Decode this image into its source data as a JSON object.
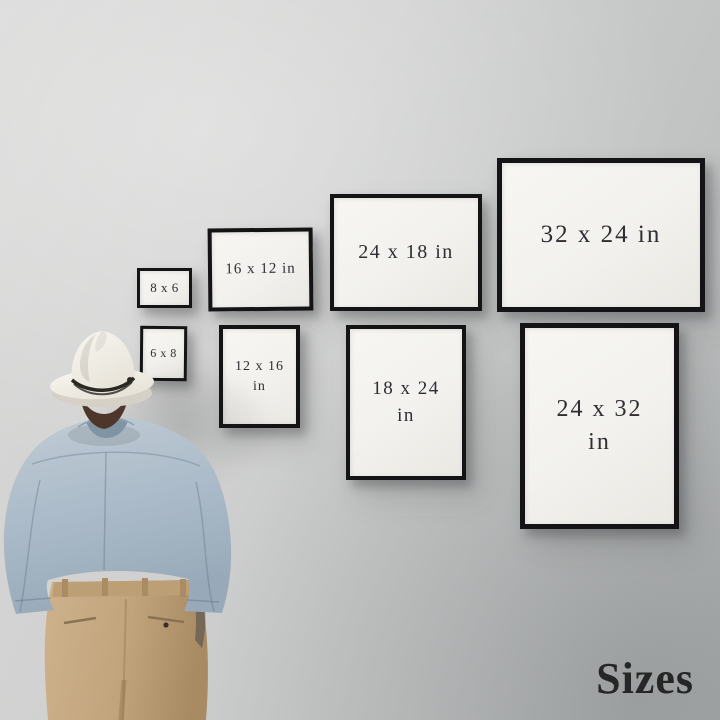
{
  "watermark": {
    "label": "Sizes"
  },
  "frames": [
    {
      "name": "frame-8x6",
      "lines": [
        "8 x 6"
      ]
    },
    {
      "name": "frame-16x12",
      "lines": [
        "16 x 12 in"
      ]
    },
    {
      "name": "frame-24x18",
      "lines": [
        "24 x 18 in"
      ]
    },
    {
      "name": "frame-32x24",
      "lines": [
        "32 x 24 in"
      ]
    },
    {
      "name": "frame-6x8",
      "lines": [
        "6 x 8"
      ]
    },
    {
      "name": "frame-12x16",
      "lines": [
        "12 x 16",
        "in"
      ]
    },
    {
      "name": "frame-18x24",
      "lines": [
        "18 x 24",
        "in"
      ]
    },
    {
      "name": "frame-24x32",
      "lines": [
        "24 x 32",
        "in"
      ]
    }
  ],
  "colors": {
    "wall_light": "#d9d9d8",
    "wall_dark": "#b3b6b6",
    "frame_border": "#141416",
    "frame_mat": "#f2f1ed",
    "label_text": "#2e2e33",
    "watermark_text": "#262626",
    "hat": "#f4f1ea",
    "hat_band": "#2b2723",
    "hair": "#4e362a",
    "shirt": "#aebdca",
    "pants": "#c2a47c"
  }
}
